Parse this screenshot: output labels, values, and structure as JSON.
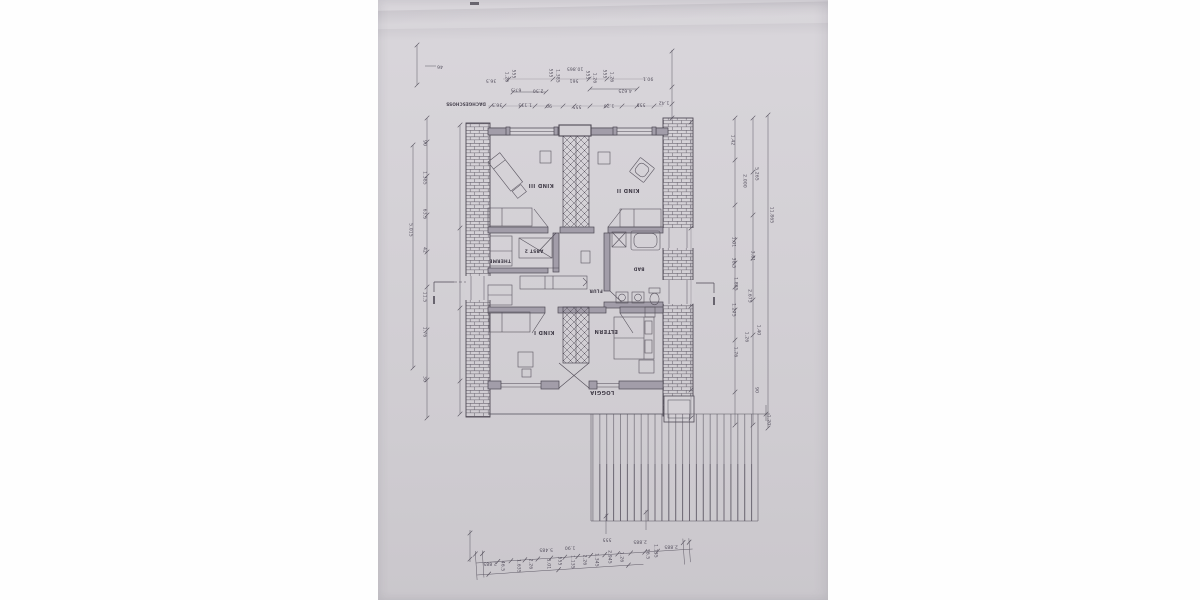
{
  "document": {
    "floor_label": "DACHGESCHOSS",
    "paper_color": "#d3d0d5",
    "ink_color": "#4e4954"
  },
  "rooms": [
    {
      "name": "KIND III"
    },
    {
      "name": "KIND II"
    },
    {
      "name": "ABST 2"
    },
    {
      "name": "THERME"
    },
    {
      "name": "BAD"
    },
    {
      "name": "FLUR"
    },
    {
      "name": "KIND I"
    },
    {
      "name": "ELTERN"
    },
    {
      "name": "LOGGIA"
    }
  ],
  "dimension_labels": [
    {
      "t": "46",
      "x": 62,
      "y": 66,
      "r": 180
    },
    {
      "t": "10.865",
      "x": 197,
      "y": 68,
      "r": 180
    },
    {
      "t": "561",
      "x": 196,
      "y": 80,
      "r": 180
    },
    {
      "t": "36.5",
      "x": 113,
      "y": 80,
      "r": 180
    },
    {
      "t": "1.26",
      "x": 128,
      "y": 77,
      "r": 90
    },
    {
      "t": "555",
      "x": 135,
      "y": 74,
      "r": 90
    },
    {
      "t": "555",
      "x": 172,
      "y": 73,
      "r": 90
    },
    {
      "t": "1.385",
      "x": 179,
      "y": 76,
      "r": 90
    },
    {
      "t": "555",
      "x": 209,
      "y": 75,
      "r": 90
    },
    {
      "t": "1.26",
      "x": 216,
      "y": 78,
      "r": 90
    },
    {
      "t": "555",
      "x": 226,
      "y": 74,
      "r": 90
    },
    {
      "t": "1.26",
      "x": 233,
      "y": 77,
      "r": 90
    },
    {
      "t": "90.1",
      "x": 270,
      "y": 78,
      "r": 180
    },
    {
      "t": "67.5",
      "x": 138,
      "y": 89,
      "r": 180
    },
    {
      "t": "2.50",
      "x": 160,
      "y": 90,
      "r": 180
    },
    {
      "t": "4.625",
      "x": 247,
      "y": 90,
      "r": 180
    },
    {
      "t": "36.5",
      "x": 119,
      "y": 104,
      "r": 180
    },
    {
      "t": "1.135",
      "x": 147,
      "y": 104,
      "r": 180
    },
    {
      "t": "90",
      "x": 171,
      "y": 105,
      "r": 180
    },
    {
      "t": "555",
      "x": 199,
      "y": 106,
      "r": 180
    },
    {
      "t": "1.26",
      "x": 231,
      "y": 105,
      "r": 180
    },
    {
      "t": "555",
      "x": 263,
      "y": 104,
      "r": 180
    },
    {
      "t": "1.42",
      "x": 286,
      "y": 102,
      "r": 180
    },
    {
      "t": "5.015",
      "x": 32,
      "y": 230,
      "r": 90
    },
    {
      "t": "90",
      "x": 46,
      "y": 143,
      "r": 90
    },
    {
      "t": "1.385",
      "x": 46,
      "y": 178,
      "r": 90
    },
    {
      "t": "63.5",
      "x": 46,
      "y": 214,
      "r": 90
    },
    {
      "t": "42",
      "x": 46,
      "y": 250,
      "r": 90
    },
    {
      "t": "11.5",
      "x": 46,
      "y": 297,
      "r": 90
    },
    {
      "t": "1.76",
      "x": 46,
      "y": 332,
      "r": 90
    },
    {
      "t": "36",
      "x": 46,
      "y": 379,
      "r": 90
    },
    {
      "t": "1.42",
      "x": 354,
      "y": 140,
      "r": 90
    },
    {
      "t": "2.000",
      "x": 366,
      "y": 181,
      "r": 90
    },
    {
      "t": "5.265",
      "x": 378,
      "y": 174,
      "r": 90
    },
    {
      "t": "11.865",
      "x": 393,
      "y": 215,
      "r": 90
    },
    {
      "t": "1.01",
      "x": 355,
      "y": 242,
      "r": 90
    },
    {
      "t": "38.5",
      "x": 355,
      "y": 263,
      "r": 90
    },
    {
      "t": "3.81",
      "x": 374,
      "y": 256,
      "r": 90
    },
    {
      "t": "1.885",
      "x": 357,
      "y": 284,
      "r": 90
    },
    {
      "t": "2.675",
      "x": 371,
      "y": 296,
      "r": 90
    },
    {
      "t": "1.275",
      "x": 355,
      "y": 310,
      "r": 90
    },
    {
      "t": "1.40",
      "x": 380,
      "y": 330,
      "r": 90
    },
    {
      "t": "1.26",
      "x": 368,
      "y": 337,
      "r": 90
    },
    {
      "t": "1.76",
      "x": 357,
      "y": 352,
      "r": 90
    },
    {
      "t": "90",
      "x": 378,
      "y": 390,
      "r": 90
    },
    {
      "t": "1.20",
      "x": 390,
      "y": 420,
      "r": 90
    },
    {
      "t": "2.885",
      "x": 112,
      "y": 563,
      "r": 180
    },
    {
      "t": "46.5",
      "x": 124,
      "y": 566,
      "r": 90
    },
    {
      "t": "1.635",
      "x": 140,
      "y": 566,
      "r": 90
    },
    {
      "t": "2.26",
      "x": 152,
      "y": 564,
      "r": 90
    },
    {
      "t": "5.485",
      "x": 168,
      "y": 549,
      "r": 180
    },
    {
      "t": "1.01",
      "x": 170,
      "y": 564,
      "r": 90
    },
    {
      "t": "555",
      "x": 181,
      "y": 561,
      "r": 90
    },
    {
      "t": "1.90",
      "x": 192,
      "y": 547,
      "r": 180
    },
    {
      "t": "1.135",
      "x": 194,
      "y": 562,
      "r": 90
    },
    {
      "t": "2.26",
      "x": 206,
      "y": 560,
      "r": 90
    },
    {
      "t": "1.345",
      "x": 218,
      "y": 560,
      "r": 90
    },
    {
      "t": "555",
      "x": 229,
      "y": 539,
      "r": 180
    },
    {
      "t": "2.945",
      "x": 231,
      "y": 557,
      "r": 90
    },
    {
      "t": "1.26",
      "x": 243,
      "y": 557,
      "r": 90
    },
    {
      "t": "2.885",
      "x": 262,
      "y": 541,
      "r": 180
    },
    {
      "t": "36.5",
      "x": 269,
      "y": 554,
      "r": 90
    },
    {
      "t": "1.135",
      "x": 277,
      "y": 551,
      "r": 90
    },
    {
      "t": "2.885",
      "x": 293,
      "y": 546,
      "r": 180
    }
  ]
}
